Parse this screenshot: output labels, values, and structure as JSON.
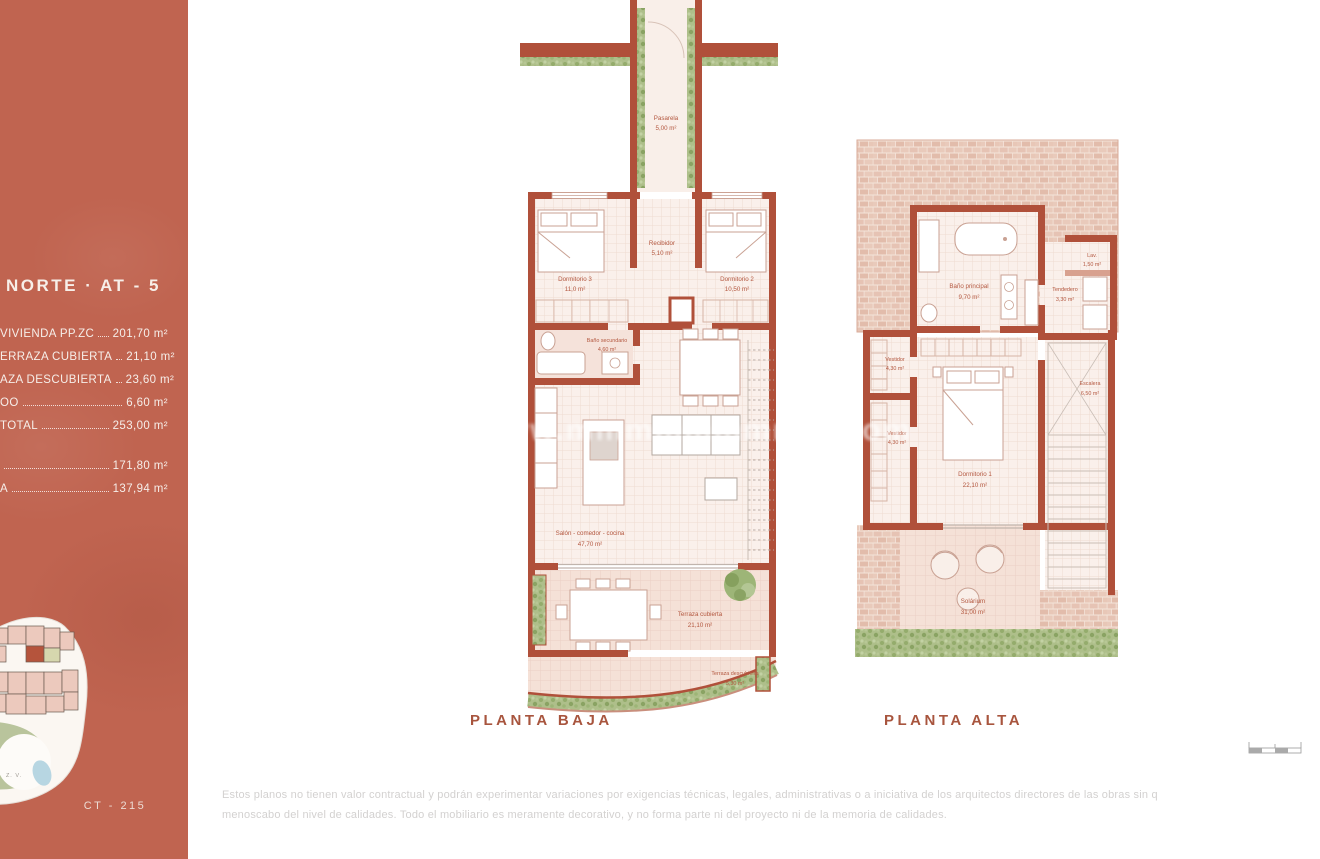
{
  "colors": {
    "sidebar_bg": "#c06450",
    "wall_red": "#b0503a",
    "label_terracotta": "#b3573f",
    "caption_terracotta": "#a8553e",
    "hedge_green": "#a9bf85",
    "brick_pink": "#e6c3b4",
    "floor_pink": "#faf0eb"
  },
  "sidebar": {
    "title": "NORTE · AT - 5",
    "rows": [
      {
        "label": "VIVIENDA PP.ZC",
        "value": "201,70 m²"
      },
      {
        "label": "ERRAZA CUBIERTA",
        "value": "21,10 m²"
      },
      {
        "label": "AZA DESCUBIERTA",
        "value": "23,60 m²"
      },
      {
        "label": "OO",
        "value": "6,60 m²"
      },
      {
        "label": "TOTAL",
        "value": "253,00 m²"
      },
      {
        "label": "",
        "value": "171,80 m²"
      },
      {
        "label": "A",
        "value": "137,94 m²"
      }
    ],
    "code": "CT - 215",
    "sitemap_zone_label": "Z. V."
  },
  "plans": {
    "baja": {
      "caption": "PLANTA BAJA",
      "rooms": {
        "pasarela": {
          "name": "Pasarela",
          "area": "5,00 m²"
        },
        "dorm3": {
          "name": "Dormitorio 3",
          "area": "11,0 m²"
        },
        "recibidor": {
          "name": "Recibidor",
          "area": "5,10 m²"
        },
        "dorm2": {
          "name": "Dormitorio 2",
          "area": "10,50 m²"
        },
        "bano2": {
          "name": "Baño secundario",
          "area": "4,60 m²"
        },
        "salon": {
          "name": "Salón - comedor - cocina",
          "area": "47,70 m²"
        },
        "terraza_cubierta": {
          "name": "Terraza cubierta",
          "area": "21,10 m²"
        },
        "terraza_descubierta": {
          "name": "Terraza descubierta",
          "area": "5,30 m²"
        }
      }
    },
    "alta": {
      "caption": "PLANTA ALTA",
      "rooms": {
        "bano_ppal": {
          "name": "Baño principal",
          "area": "9,70 m²"
        },
        "lav": {
          "name": "Lav.",
          "area": "1,50 m²"
        },
        "tendedero": {
          "name": "Tendedero",
          "area": "3,30 m²"
        },
        "vestidor1": {
          "name": "Vestidor",
          "area": "4,30 m²"
        },
        "vestidor2": {
          "name": "Vestidor",
          "area": "4,30 m²"
        },
        "dorm1": {
          "name": "Dormitorio 1",
          "area": "22,10 m²"
        },
        "escalera": {
          "name": "Escalera",
          "area": "6,50 m²"
        },
        "solarium": {
          "name": "Solárium",
          "area": "31,00 m²"
        }
      }
    }
  },
  "watermark": "www.mmmmmmmmm.com",
  "disclaimer": {
    "line1": "Estos planos no tienen valor contractual y podrán experimentar variaciones por exigencias técnicas, legales, administrativas o a iniciativa de los arquitectos directores de las obras sin q",
    "line2": "menoscabo del nivel de calidades. Todo el mobiliario es meramente decorativo, y no forma parte ni del proyecto ni de la memoria de calidades."
  }
}
